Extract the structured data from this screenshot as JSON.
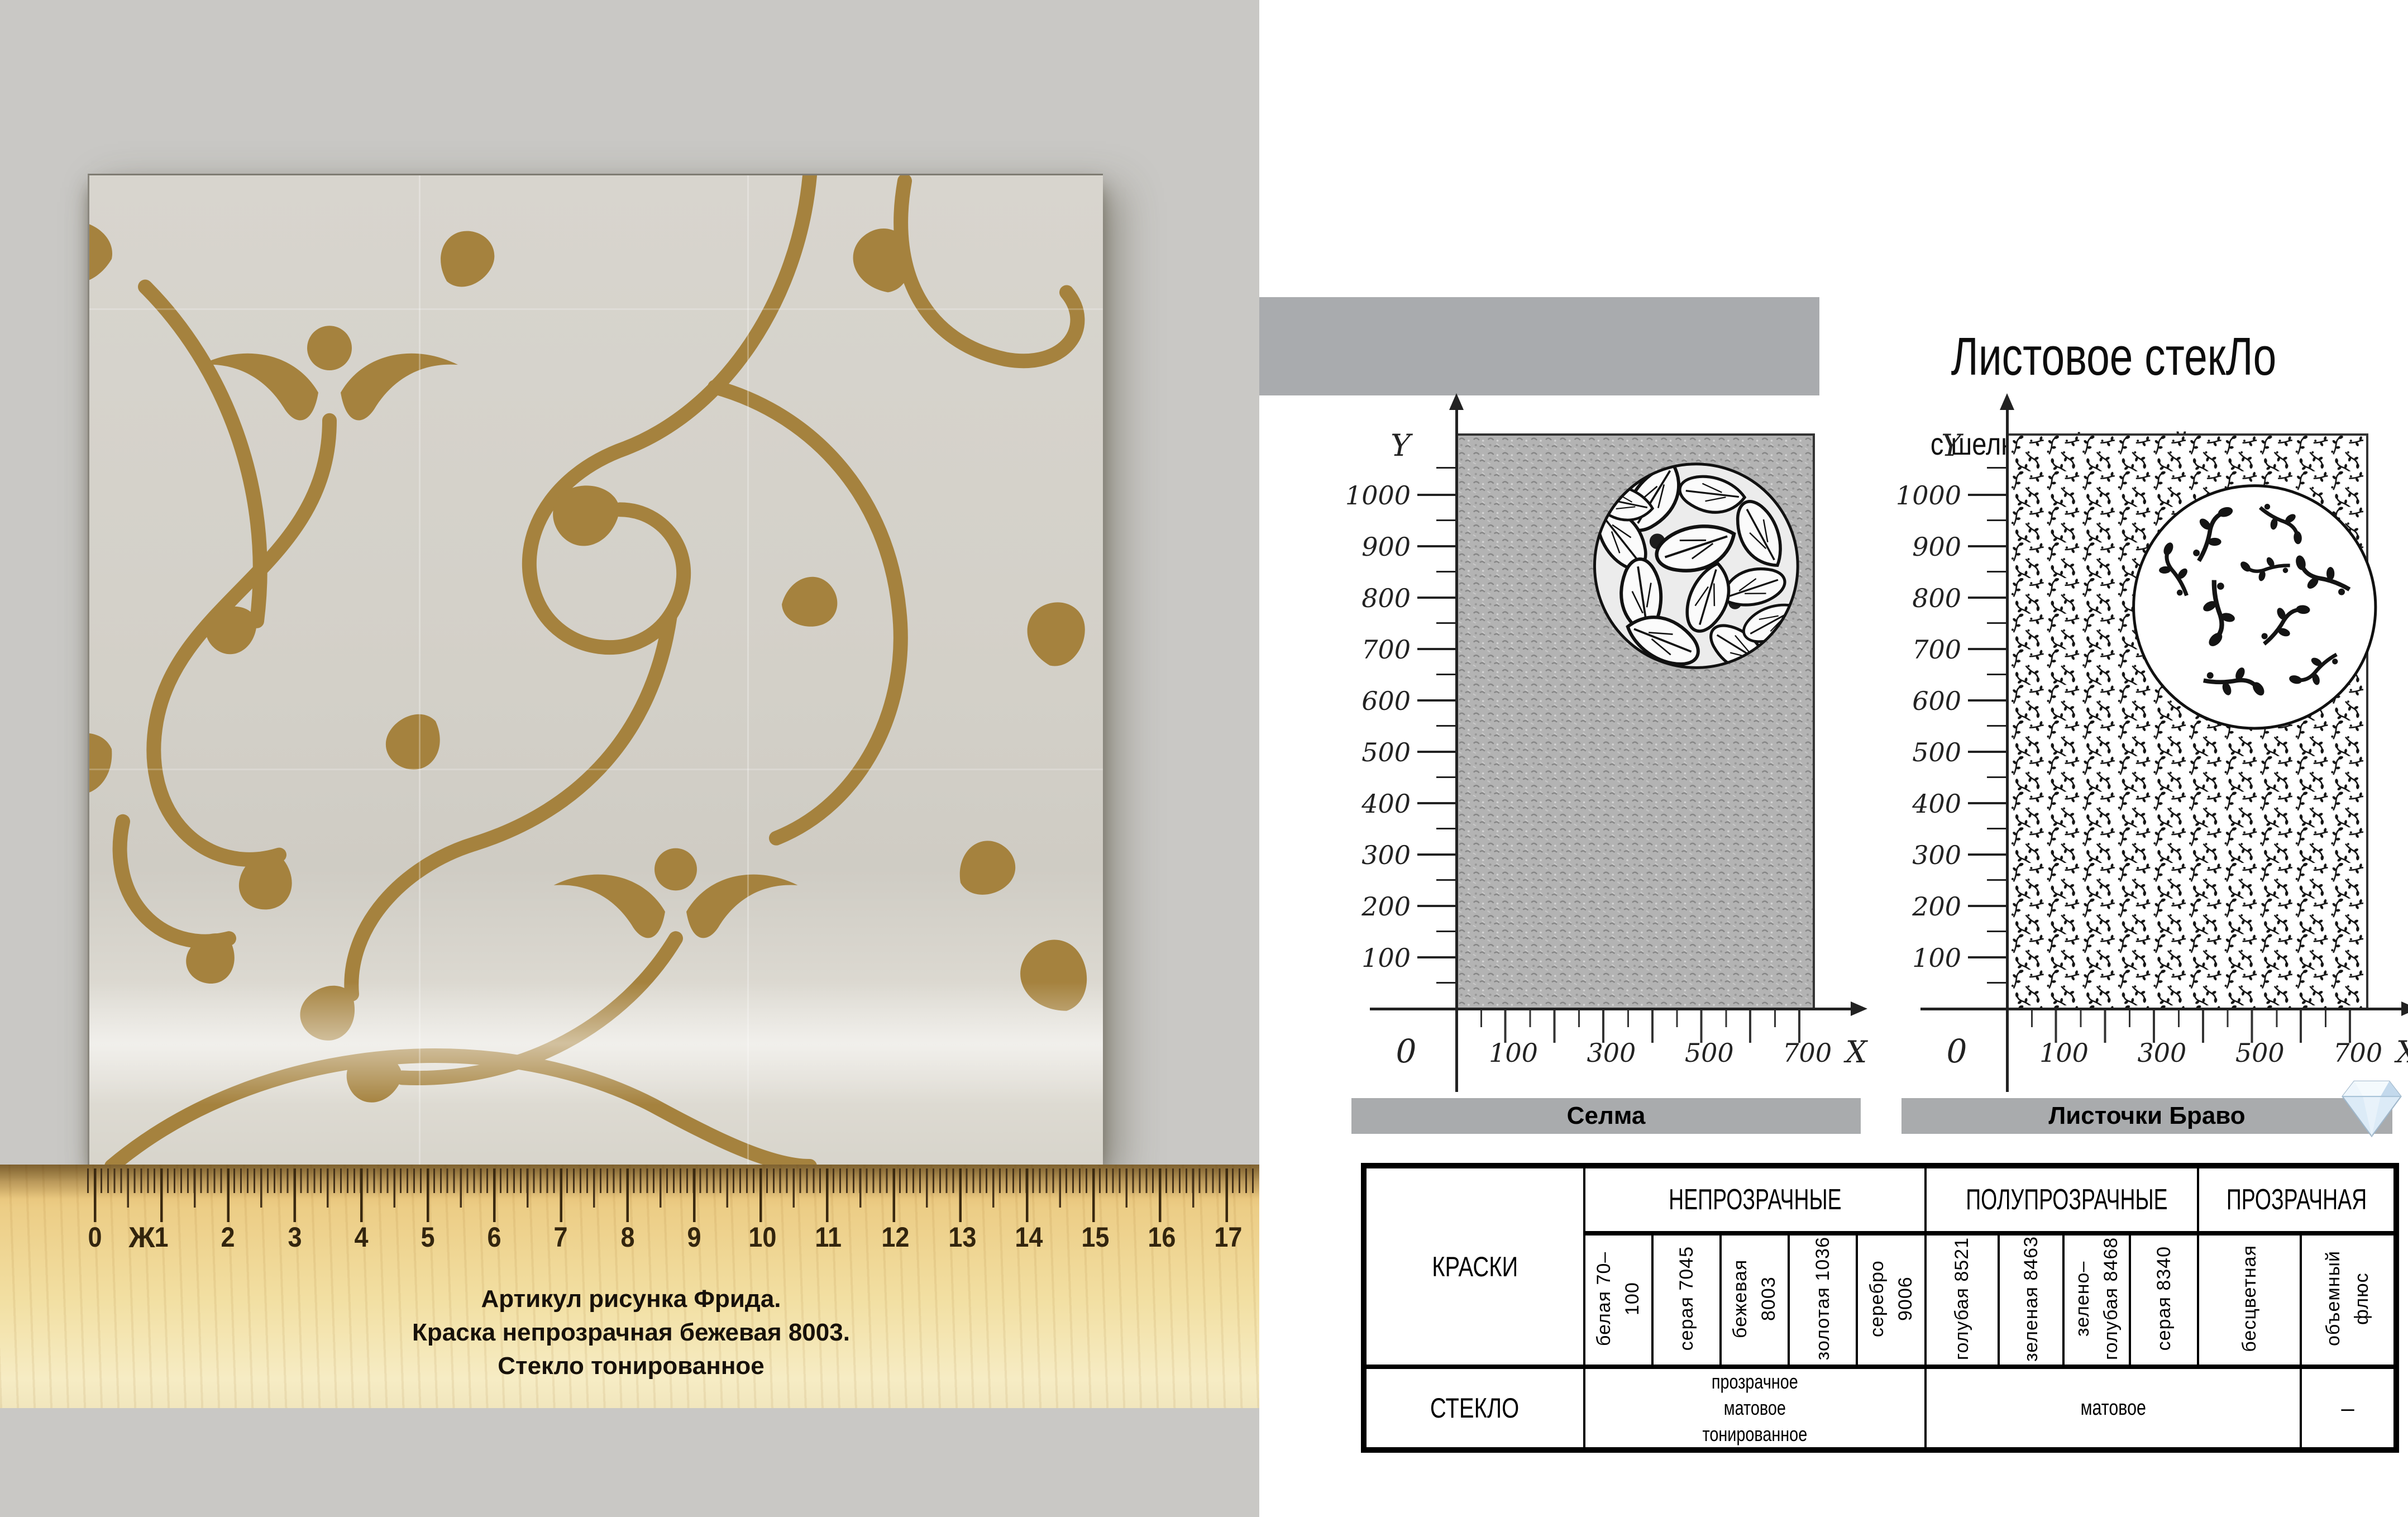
{
  "page": {
    "title": "Листовое стекЛо",
    "subtitle": "с шелкотрафаретной печатью"
  },
  "sample": {
    "caption_lines": [
      "Артикул рисунка Фрида.",
      "Краска непрозрачная бежевая 8003.",
      "Стекло тонированное"
    ],
    "colors": {
      "swirl_gold": "#a5823e",
      "glass": "#d5d2ca",
      "background_gray": "#c9c8c5",
      "wood": "#e9c87d",
      "bar_gray": "#a9abae"
    }
  },
  "ruler": {
    "numbers": [
      "0",
      "1",
      "2",
      "3",
      "4",
      "5",
      "6",
      "7",
      "8",
      "9",
      "10",
      "11",
      "12",
      "13",
      "14",
      "15",
      "16",
      "17"
    ],
    "mark": "Ж"
  },
  "charts": [
    {
      "name": "Селма",
      "y_label": "Y",
      "x_label": "X",
      "origin": "0",
      "y_ticks": [
        "1000",
        "900",
        "800",
        "700",
        "600",
        "500",
        "400",
        "300",
        "200",
        "100"
      ],
      "x_ticks": [
        "100",
        "300",
        "500",
        "700"
      ]
    },
    {
      "name": "Листочки Браво",
      "y_label": "Y",
      "x_label": "X",
      "origin": "0",
      "y_ticks": [
        "1000",
        "900",
        "800",
        "700",
        "600",
        "500",
        "400",
        "300",
        "200",
        "100"
      ],
      "x_ticks": [
        "100",
        "300",
        "500",
        "700"
      ]
    }
  ],
  "chart_data": [
    {
      "type": "area",
      "title": "Селма",
      "xlabel": "X",
      "ylabel": "Y",
      "x_ticks": [
        100,
        200,
        300,
        400,
        500,
        600,
        700
      ],
      "y_ticks": [
        100,
        200,
        300,
        400,
        500,
        600,
        700,
        800,
        900,
        1000
      ],
      "x_range": [
        0,
        730
      ],
      "y_range": [
        0,
        1140
      ],
      "note": "sheet fully covered by dense gray leaf texture, round magnifier inset at top right"
    },
    {
      "type": "area",
      "title": "Листочки Браво",
      "xlabel": "X",
      "ylabel": "Y",
      "x_ticks": [
        100,
        200,
        300,
        400,
        500,
        600,
        700
      ],
      "y_ticks": [
        100,
        200,
        300,
        400,
        500,
        600,
        700,
        800,
        900,
        1000
      ],
      "x_range": [
        0,
        730
      ],
      "y_range": [
        0,
        1140
      ],
      "note": "sheet fully covered by small scattered floral sprigs, round magnifier inset at top right"
    }
  ],
  "table": {
    "groups": [
      {
        "label": "НЕПРОЗРАЧНЫЕ",
        "span": 5
      },
      {
        "label": "ПОЛУПРОЗРАЧНЫЕ",
        "span": 4
      },
      {
        "label": "ПРОЗРАЧНАЯ",
        "span": 2
      }
    ],
    "paints_header": "КРАСКИ",
    "glass_header": "СТЕКЛО",
    "paints": [
      "белая 70–100",
      "серая 7045",
      "бежевая 8003",
      "золотая 1036",
      "серебро 9006",
      "голубая 8521",
      "зеленая 8463",
      "зелено–голубая 8468",
      "серая 8340",
      "бесцветная",
      "объемный флюс"
    ],
    "glass_opaque_lines": [
      "прозрачное",
      "матовое",
      "тонированное"
    ],
    "glass_semi": "матовое",
    "glass_transparent": "–"
  }
}
